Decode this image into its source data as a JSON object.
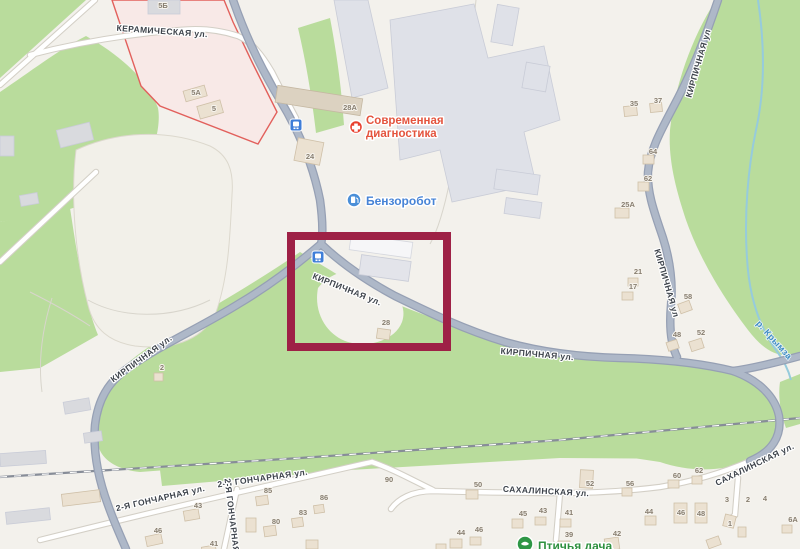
{
  "colors": {
    "highlight_box": "#9e2146",
    "greenery": "#b9dc9c",
    "road_main": "#aeb8c8",
    "water": "#96cbdc",
    "industrial_zone_fill": "#f8e9e7",
    "industrial_zone_border": "#e2605c",
    "poi_medical": "#e4543e",
    "poi_fuel": "#4683d6",
    "poi_bird": "#2f9140"
  },
  "streets": {
    "keramicheskaya": "КЕРАМИЧЕСКАЯ ул.",
    "kirpichnaya": "КИРПИЧНАЯ ул.",
    "kirpichnaya_short": "КИРПИЧНАЯ ул",
    "goncharnaya": "2-Я ГОНЧАРНАЯ ул.",
    "sakhalinskaya": "САХАЛИНСКАЯ ул.",
    "river": "р. Крымза"
  },
  "pois": {
    "medical": {
      "name": "Современная диагностика",
      "line1": "Современная",
      "line2": "диагностика"
    },
    "fuel": {
      "name": "Бензоробот"
    },
    "bird": {
      "name": "Птичья дача"
    }
  },
  "buildings": [
    "5Б",
    "5А",
    "5",
    "28А",
    "24",
    "35",
    "37",
    "64",
    "62",
    "25А",
    "21",
    "17",
    "58",
    "48",
    "52",
    "28",
    "2",
    "90",
    "50",
    "52",
    "45",
    "43",
    "41",
    "44",
    "46",
    "39",
    "42",
    "56",
    "60",
    "62",
    "3",
    "2",
    "4",
    "44",
    "46",
    "48",
    "1",
    "6А",
    "43",
    "46",
    "41",
    "85",
    "80",
    "83",
    "86"
  ]
}
